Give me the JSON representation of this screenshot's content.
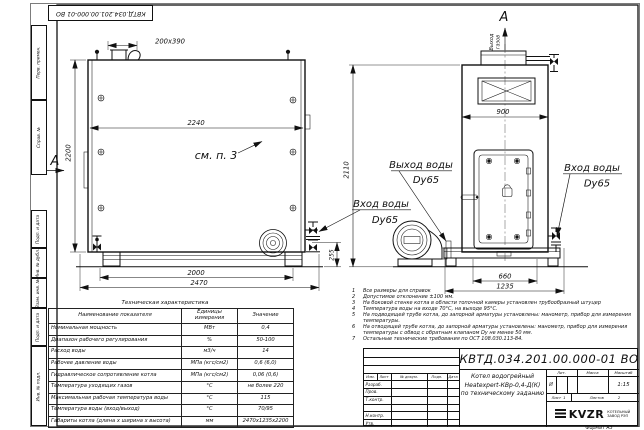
{
  "margin": {
    "stamp": "КВТД.034.201.00.000-01 ВО",
    "columns": [
      "Перв. примен.",
      "Справ. №",
      "Подп. и дата",
      "Инв. № дубл.",
      "Взам. инв. №",
      "Подп. и дата",
      "Инв. № подл."
    ]
  },
  "dims": {
    "chimney": "200х390",
    "front_width_inner": "2240",
    "front_height": "2200",
    "front_base": "2000",
    "front_total": "2470",
    "front_offset": "255",
    "side_width": "900",
    "side_height": "2110",
    "side_base": "660",
    "side_total": "1235"
  },
  "callouts": {
    "section": "А",
    "see_note": "см. п. 3",
    "gas_out_line1": "Выход",
    "gas_out_line2": "газов",
    "water_out": "Выход воды",
    "water_in": "Вход воды",
    "dn": "Dy65"
  },
  "tech_table": {
    "title": "Техническая характеристика",
    "headers": [
      "Наименование показателя",
      "Единицы измерения",
      "Значение"
    ],
    "rows": [
      [
        "Номинальная мощность",
        "МВт",
        "0,4"
      ],
      [
        "Диапазон рабочего регулирования",
        "%",
        "50-100"
      ],
      [
        "Расход воды",
        "м3/ч",
        "14"
      ],
      [
        "Рабочее давление воды",
        "МПа (кгс/см2)",
        "0,6 (6,0)"
      ],
      [
        "Гидравлическое сопротивление котла",
        "МПа (кгс/см2)",
        "0,06 (0,6)"
      ],
      [
        "Температура уходящих газов",
        "°С",
        "не более 220"
      ],
      [
        "Максимальная рабочая температура воды",
        "°С",
        "115"
      ],
      [
        "Температура воды (вход/выход)",
        "°С",
        "70/95"
      ],
      [
        "Габариты котла (длина х ширина х высота)",
        "мм",
        "2470х1235х2200"
      ]
    ]
  },
  "notes": [
    "Все размеры для справок",
    "Допустимое отклонение ±100 мм.",
    "На боковой стенке котла в области топочной камеры установлен трубообразный штуцер",
    "Температура воды на входе 70°С, на выходе 95°С.",
    "На подводящей трубе котла, до запорной арматуры установлены: манометр, прибор для измерения температуры.",
    "На отводящей трубе котла, до запорной арматуры установлены: манометр, прибор для измерения температуры с обвод с обратным клапаном Dу не менее 50 мм.",
    "Остальные технические требования по ОСТ 108.030.113-84."
  ],
  "title_block": {
    "doc_number": "КВТД.034.201.00.000-01 ВО",
    "product_line1": "Котел водогрейный",
    "product_line2": "Heatexpert-КВр-0,4-Д(К)",
    "product_line3": "по техническому заданию",
    "cols": [
      "Изм.",
      "Лист",
      "№ докум.",
      "Подп.",
      "Дата"
    ],
    "sign_rows": [
      "Разраб.",
      "Пров.",
      "Т.контр.",
      "Н.контр.",
      "Утв."
    ],
    "lit_label": "Лит.",
    "lit_value": "И",
    "mass_label": "Масса",
    "scale_label": "Масштаб",
    "scale_value": "1:15",
    "sheet_label": "Лист",
    "sheet_value": "1",
    "sheets_label": "Листов",
    "sheets_value": "2",
    "logo_text": "KVZR",
    "logo_caption_1": "КОТЕЛЬНЫЙ",
    "logo_caption_2": "ЗАВОД РЭП",
    "format_label": "Формат А3"
  }
}
